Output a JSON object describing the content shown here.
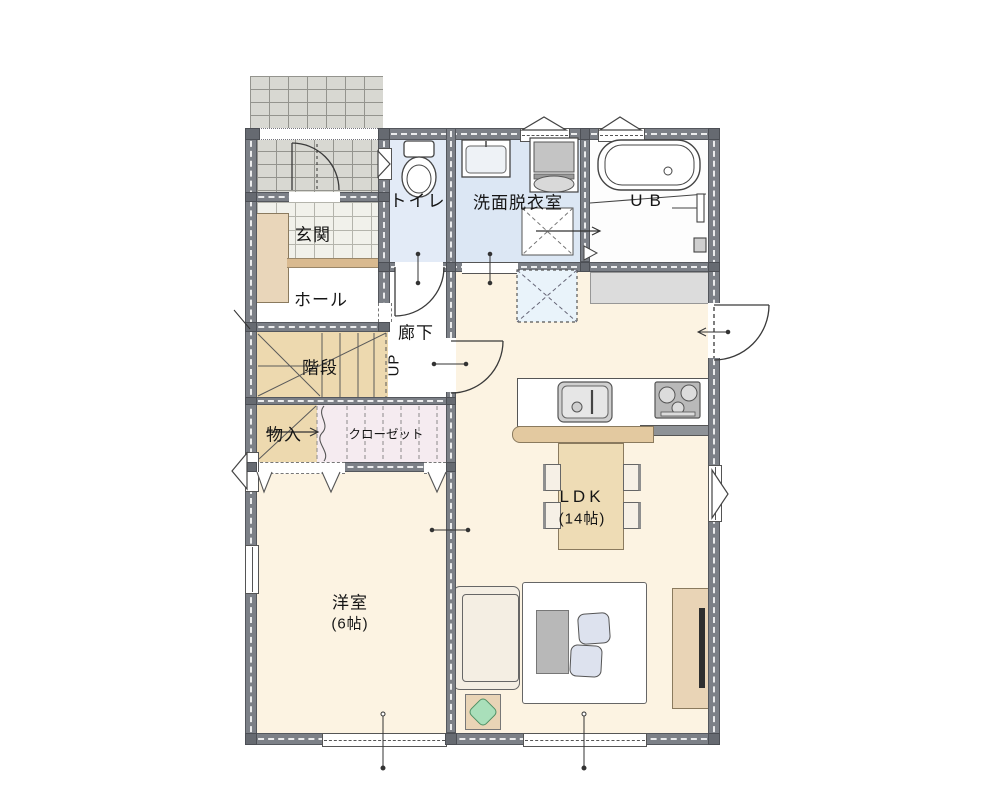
{
  "plan": {
    "type": "floor-plan",
    "rooms": {
      "genkan": {
        "label": "玄関"
      },
      "hall": {
        "label": "ホール"
      },
      "toilet": {
        "label": "トイレ"
      },
      "washroom": {
        "label": "洗面脱衣室"
      },
      "bath": {
        "label": "UB"
      },
      "corridor": {
        "label": "廊下"
      },
      "stairs": {
        "label": "階段",
        "direction": "UP"
      },
      "storage": {
        "label": "物入"
      },
      "closet": {
        "label": "クローゼット"
      },
      "ldk": {
        "label": "LDK",
        "size": "(14帖)"
      },
      "western_room": {
        "label": "洋室",
        "size": "(6帖)"
      }
    },
    "fixtures": [
      "bathtub",
      "toilet",
      "vanity-sink",
      "washing-machine",
      "bath-mat",
      "floor-hatch",
      "kitchen-sink",
      "gas-stove",
      "kitchen-counter",
      "dining-table",
      "chair",
      "sofa",
      "rug",
      "coffee-table",
      "floor-cushion",
      "tv-board",
      "tv",
      "plant",
      "shoe-cabinet",
      "entrance-step"
    ],
    "colors": {
      "wall": "#7c8087",
      "floor_cream": "#fcf3e2",
      "floor_tan": "#edd9af",
      "floor_closet": "#f5ebf0",
      "floor_toilet": "#e3ebf7",
      "floor_washroom": "#dce7f4",
      "tile_porch": "#d8d8d2",
      "tile_genkan": "#f1f1eb",
      "wood": "#e8d4b4",
      "mat_blue": "#e9f3fa",
      "plant_green": "#a9dfba"
    }
  }
}
